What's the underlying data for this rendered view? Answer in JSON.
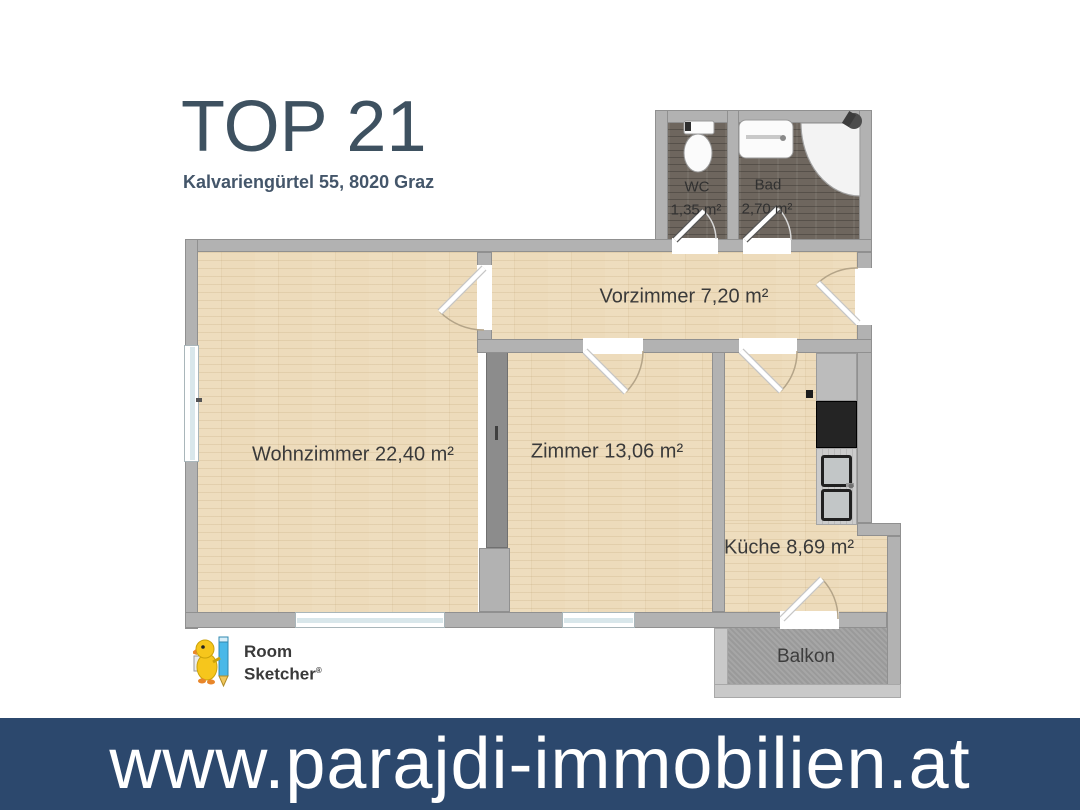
{
  "header": {
    "title": "TOP 21",
    "subtitle": "Kalvariengürtel 55, 8020 Graz"
  },
  "rooms": {
    "wc": {
      "name": "WC",
      "area": "1,35 m²"
    },
    "bad": {
      "name": "Bad",
      "area": "2,70 m²"
    },
    "vorzimmer": {
      "label": "Vorzimmer 7,20 m²"
    },
    "wohnzimmer": {
      "label": "Wohnzimmer 22,40 m²"
    },
    "zimmer": {
      "label": "Zimmer 13,06 m²"
    },
    "kueche": {
      "label": "Küche 8,69 m²"
    },
    "balkon": {
      "label": "Balkon"
    }
  },
  "logo": {
    "line1": "Room",
    "line2": "Sketcher",
    "registered": "®"
  },
  "footer": {
    "website": "www.parajdi-immobilien.at"
  },
  "colors": {
    "banner": "#2c486d",
    "title": "#3e5160",
    "wood_floor": "#eddbbb",
    "dark_floor": "#6e665e",
    "wall": "#b2b2b2",
    "balcony_floor": "#a2a2a2"
  }
}
